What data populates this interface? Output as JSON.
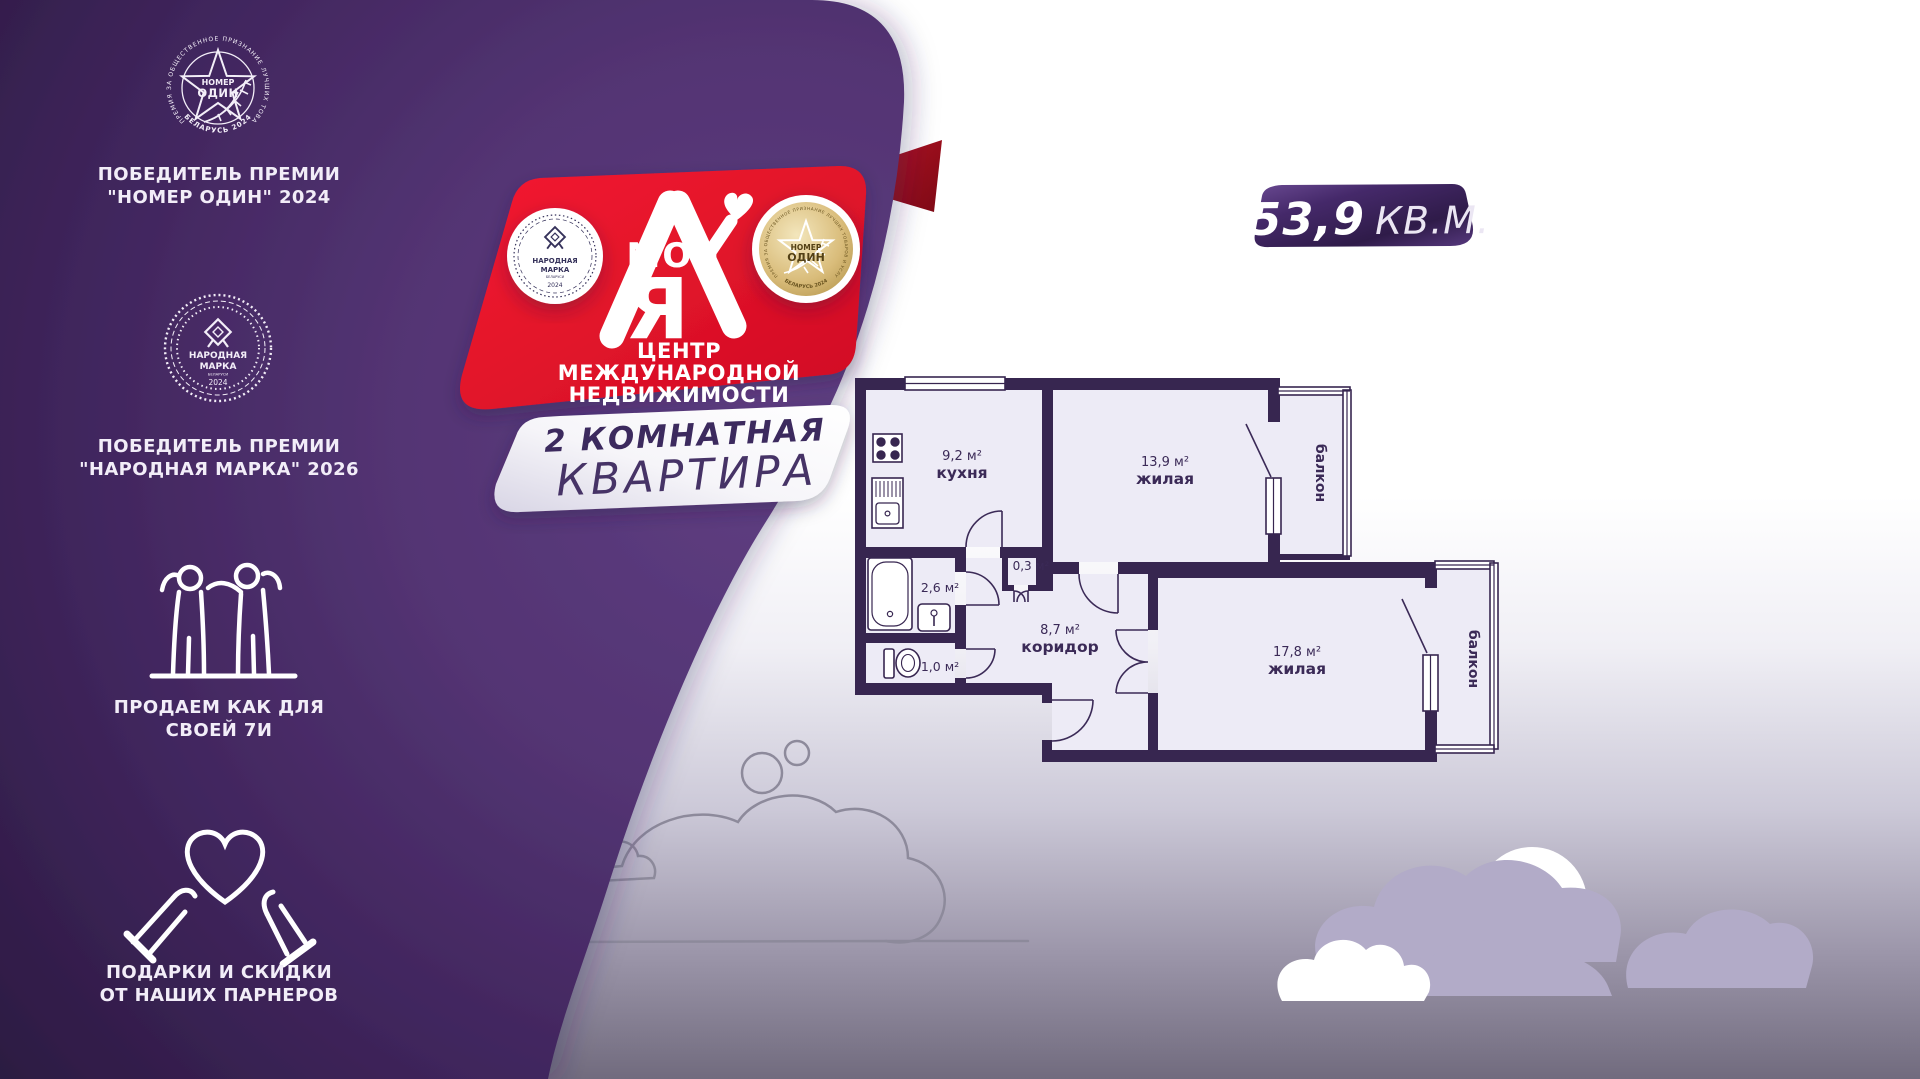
{
  "sidebar": {
    "award_top": {
      "ring_text": "ПРЕМИЯ ЗА ОБЩЕСТВЕННОЕ ПРИЗНАНИЕ ЛУЧШИХ ТОВАРОВ И УСЛУГ",
      "ring_bottom": "БЕЛАРУСЬ 2024",
      "medal_word1": "НОМЕР",
      "medal_word2": "ОДИН",
      "caption1": "ПОБЕДИТЕЛЬ ПРЕМИИ",
      "caption2": "\"НОМЕР ОДИН\" 2024"
    },
    "award_mark": {
      "medal_word1": "НАРОДНАЯ",
      "medal_word2": "МАРКА",
      "medal_sub": "БЕЛАРУСИ",
      "medal_year": "2024",
      "caption1": "ПОБЕДИТЕЛЬ ПРЕМИИ",
      "caption2": "\"НАРОДНАЯ МАРКА\" 2026"
    },
    "family": {
      "caption1": "ПРОДАЕМ КАК ДЛЯ",
      "caption2": "СВОЕЙ 7И"
    },
    "gifts": {
      "caption1": "ПОДАРКИ И СКИДКИ",
      "caption2": "ОТ НАШИХ ПАРНЕРОВ"
    }
  },
  "banner": {
    "logo_word": "МОЯ",
    "logo_letter": "Я",
    "tagline1": "ЦЕНТР МЕЖДУНАРОДНОЙ",
    "tagline2": "НЕДВИЖИМОСТИ",
    "medal_left": {
      "word1": "НАРОДНАЯ",
      "word2": "МАРКА",
      "sub": "БЕЛАРУСИ",
      "year": "2024"
    },
    "medal_right": {
      "word1": "НОМЕР",
      "word2": "ОДИН",
      "ring_text": "ПРЕМИЯ ЗА ОБЩЕСТВЕННОЕ ПРИЗНАНИЕ ЛУЧШИХ ТОВАРОВ И УСЛУГ",
      "ring_bottom": "БЕЛАРУСЬ 2024"
    }
  },
  "listing": {
    "type_line1": "2 КОМНАТНАЯ",
    "type_line2": "КВАРТИРА",
    "area_value": "53,9",
    "area_unit": "КВ.М."
  },
  "floor_plan": {
    "kitchen": {
      "area": "9,2 м²",
      "name": "кухня"
    },
    "room1": {
      "area": "13,9 м²",
      "name": "жилая"
    },
    "room2": {
      "area": "17,8 м²",
      "name": "жилая"
    },
    "corridor": {
      "area": "8,7 м²",
      "name": "коридор"
    },
    "bathroom": {
      "area": "2,6 м²"
    },
    "wc": {
      "area": "1,0 м²"
    },
    "closet": {
      "area": "0,3 м²"
    },
    "balcony_top": {
      "name": "балкон"
    },
    "balcony_bottom": {
      "name": "балкон"
    }
  },
  "colors": {
    "purple_dark": "#2c1a42",
    "purple_light": "#5f3e82",
    "red": "#e8152b",
    "red_fold": "#8f0d1c",
    "wall": "#372650",
    "floor": "#edebf6",
    "gold": "#caa64e",
    "cloud_lavender": "#b2abc8"
  }
}
